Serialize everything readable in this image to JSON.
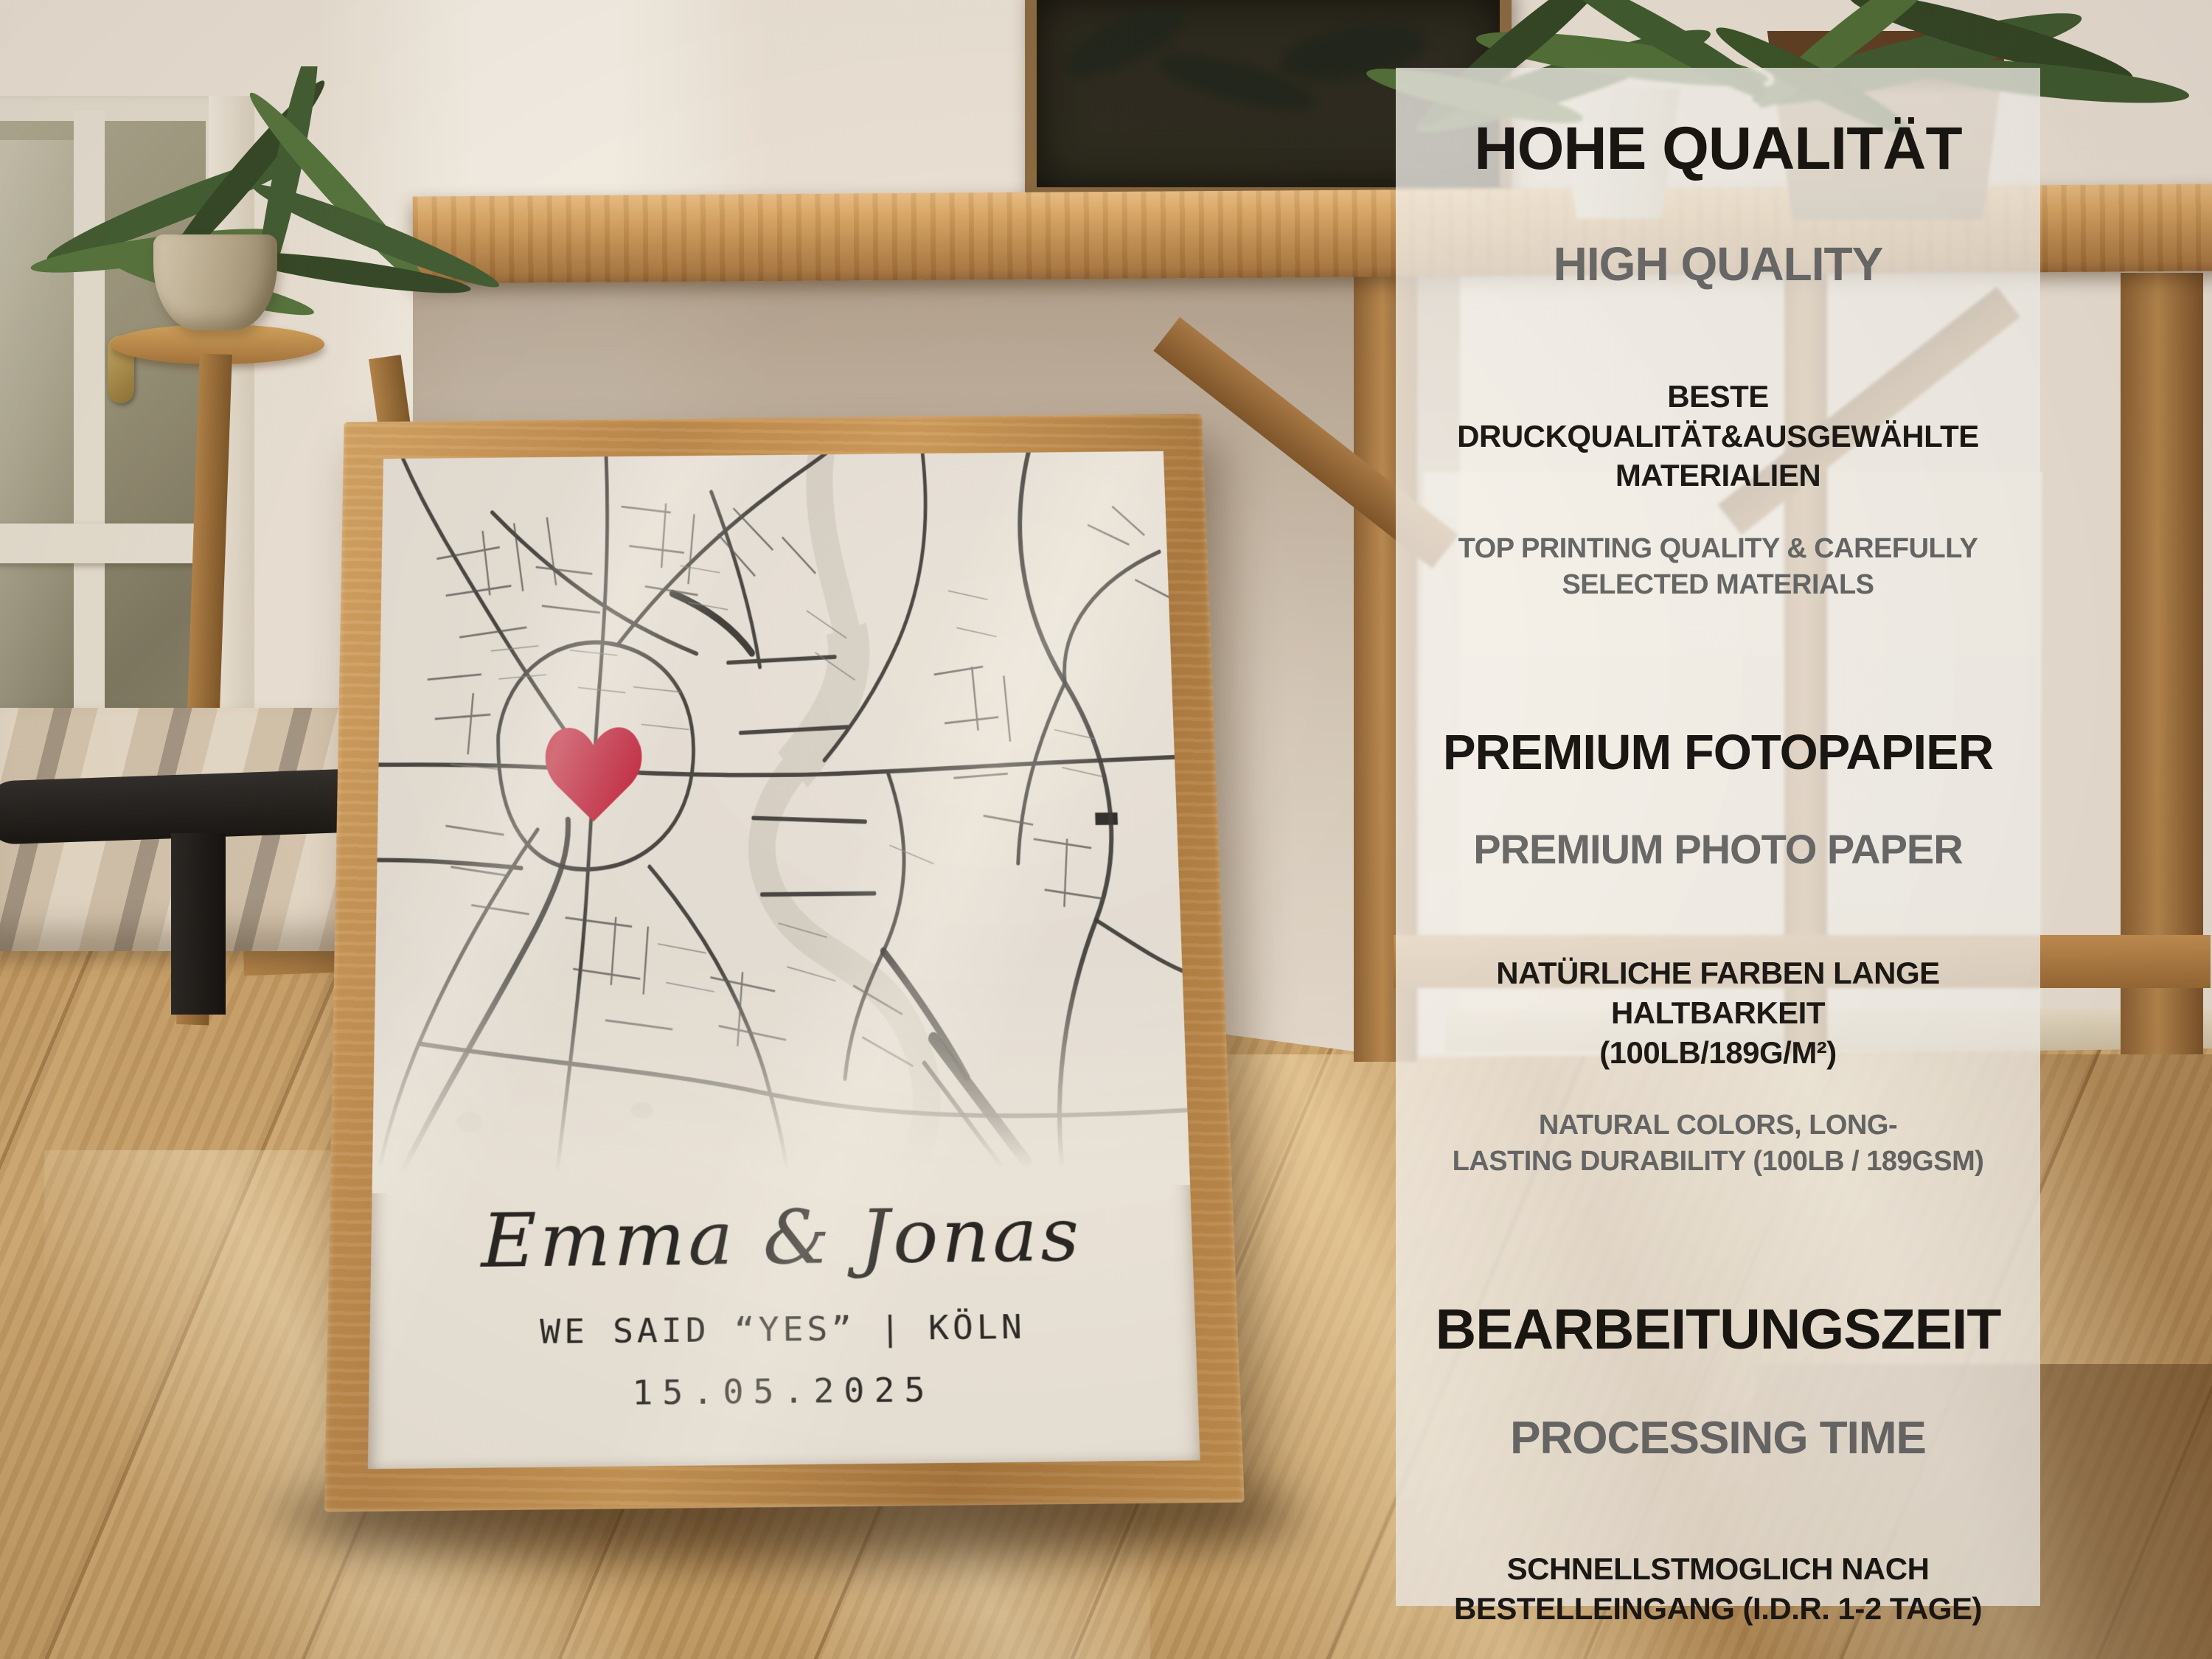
{
  "poster": {
    "couple_names": "Emma & Jonas",
    "caption": "WE SAID “YES” | KÖLN",
    "date": "15.05.2025",
    "heart_color": "#c22340",
    "frame_wood_color": "#c08b4c",
    "paper_color": "#f2eee5"
  },
  "info_panel": {
    "background_color": "#ffffff",
    "heading_color": "#101010",
    "subheading_color": "#66696c",
    "sections": [
      {
        "icon": "award-badge-thumbs-up-icon",
        "heading_de": "HOHE QUALITÄT",
        "heading_en": "HIGH QUALITY",
        "body_de": "BESTE\nDRUCKQUALITÄT&AUSGEWÄHLTE\nMATERIALIEN",
        "body_en": "TOP PRINTING QUALITY & CAREFULLY\nSELECTED MATERIALS"
      },
      {
        "icon": "camera-icon",
        "heading_de": "PREMIUM FOTOPAPIER",
        "heading_en": "PREMIUM PHOTO PAPER",
        "body_de": "NATÜRLICHE FARBEN LANGE\nHALTBARKEIT\n(100LB/189G/M²)",
        "body_en": "NATURAL COLORS, LONG-\nLASTING DURABILITY (100LB / 189GSM)"
      },
      {
        "icon": "alarm-clock-icon",
        "heading_de": "BEARBEITUNGSZEIT",
        "heading_en": "PROCESSING TIME",
        "body_de": "SCHNELLSTMOGLICH NACH\nBESTELLEINGANG (I.D.R. 1-2 TAGE)",
        "body_en": "AS FAST AS POSSIBLE\nAFTER ORDER (USUALLY 1–2 DAYS)"
      }
    ]
  }
}
